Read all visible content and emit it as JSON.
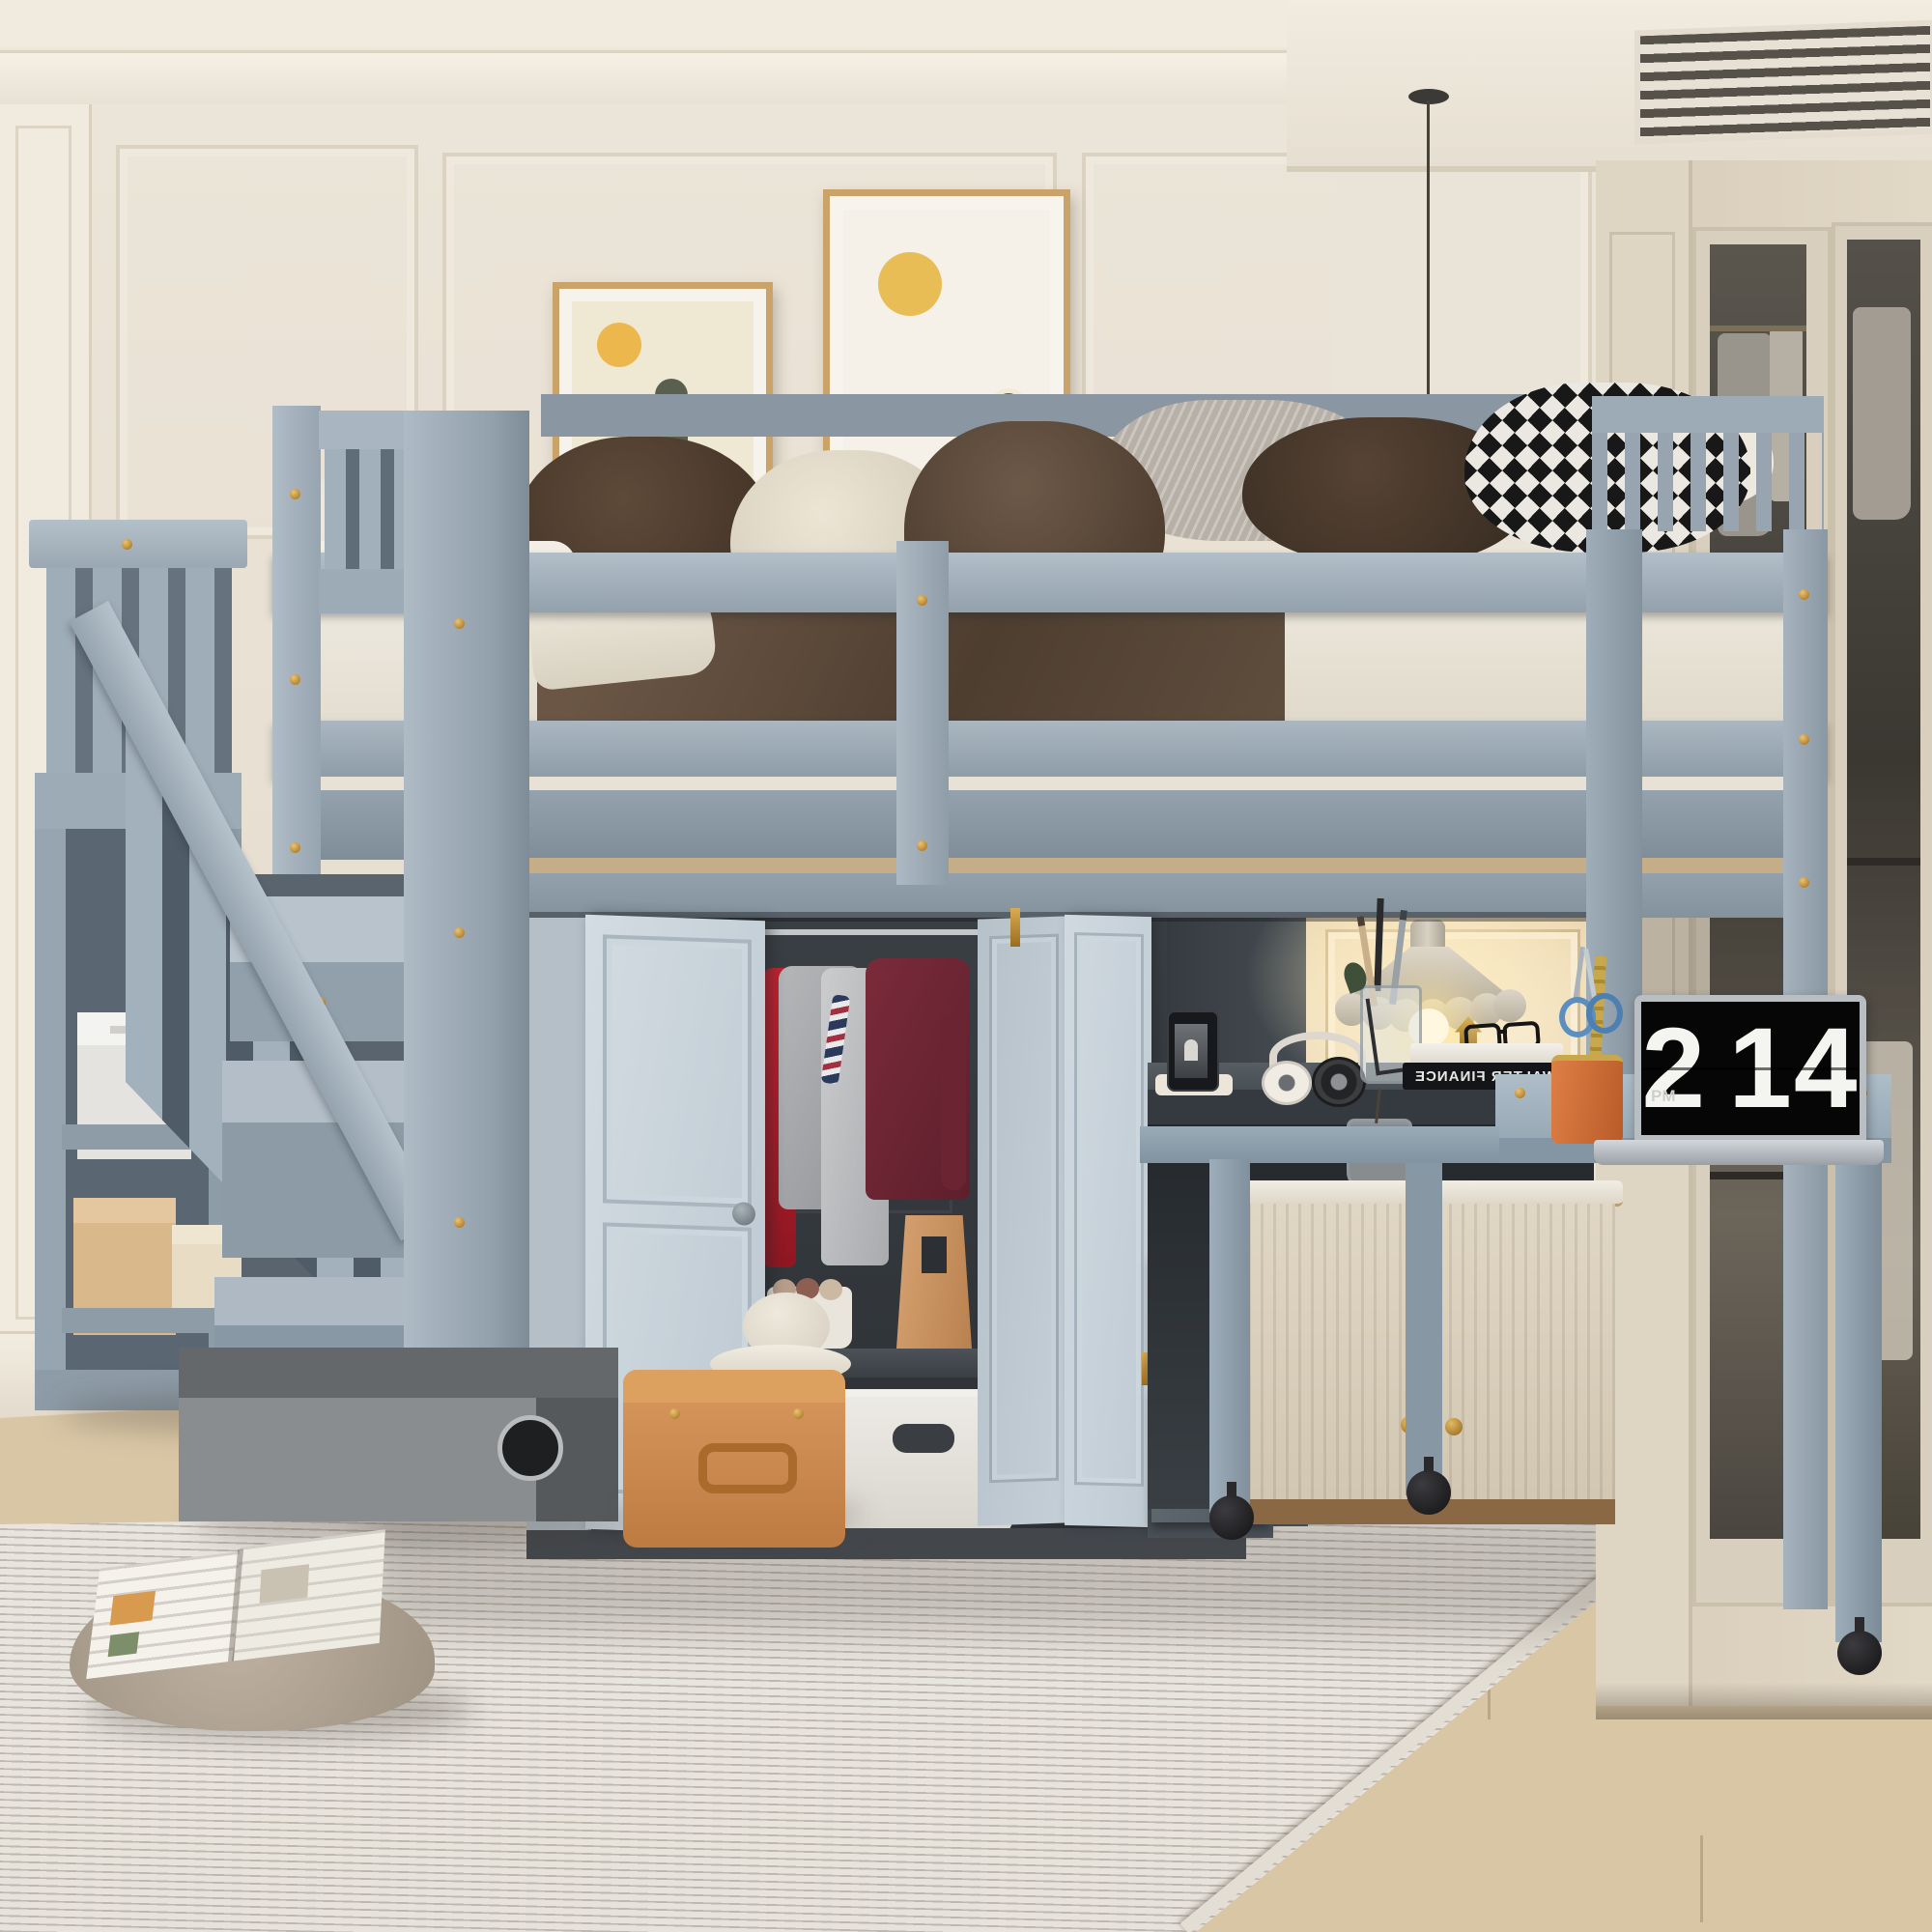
{
  "scene": {
    "description": "Lifestyle product photo: gray wooden loft bed with storage staircase, built-in wardrobe with open bi-fold doors, under-bed desk nook with pendant lamp and pull-out rolling table, in a cream wainscot-paneled bedroom",
    "room": {
      "wall_style": "cream wainscot paneling with crown molding and AC vent soffit",
      "floor": "light oak plank floor",
      "rug": "ivory ribbed area rug"
    }
  },
  "palette": {
    "bed_gray": "#9aa8b4",
    "door_gray": "#ccd6dd",
    "dark_interior": "#34383c",
    "wall_cream": "#eae3d7",
    "builtin_cream": "#ded4c3",
    "wood_floor": "#d9c6a5",
    "accent_brass": "#c08a2e",
    "lamp_glow": "#f7e7c2",
    "art_orange": "#dd9a50",
    "sweater_maroon": "#6f2634",
    "shirt_red": "#c02330"
  },
  "laptop": {
    "clock_meridiem": "PM",
    "clock_hour": "2",
    "clock_minute": "14"
  },
  "desk_items": {
    "book_spine_text": "WALTER FINANCE",
    "book_spine_mirrored_note": "spine text appears mirrored in the photo",
    "dice_letter": "T"
  },
  "artwork": {
    "left": {
      "subject": "cactus with yellow sun and pale dunes",
      "frame": "thin gold frame with white mat"
    },
    "right": {
      "subject": "cactus with yellow sun over orange desert waves",
      "frame": "thin gold frame with white mat"
    }
  },
  "wardrobe_contents": [
    "red shirt",
    "gray t-shirt",
    "striped t-shirt",
    "maroon sweater",
    "tan paper bag",
    "tray with rolled towels",
    "white storage basket",
    "beige storage box"
  ],
  "stair_storage": [
    "white gift box",
    "tan box",
    "cream box"
  ],
  "floor_items": [
    "gray storage box",
    "tan suitcase",
    "white hat",
    "taupe floor pillow",
    "open magazine"
  ]
}
